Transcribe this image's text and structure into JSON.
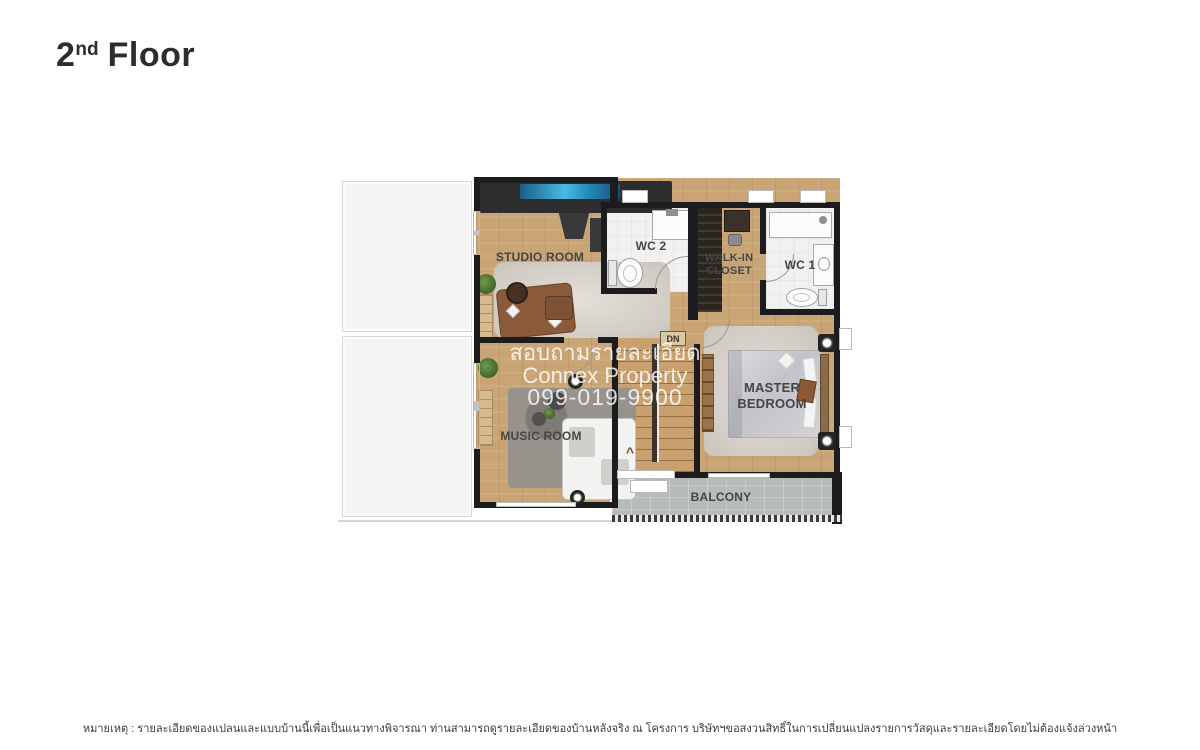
{
  "page": {
    "title": {
      "number": "2",
      "ordinal": "nd",
      "word": "Floor"
    }
  },
  "floor_plan": {
    "rooms": {
      "studio_room": {
        "label": "STUDIO ROOM"
      },
      "wc2": {
        "label": "WC 2"
      },
      "walk_in_closet": {
        "label": "WALK-IN\nCLOSET"
      },
      "wc1": {
        "label": "WC 1"
      },
      "master_bedroom": {
        "label": "MASTER\nBEDROOM"
      },
      "music_room": {
        "label": "MUSIC ROOM"
      },
      "balcony": {
        "label": "BALCONY"
      },
      "stairs": {
        "label": "DN",
        "direction_arrow": "^"
      }
    },
    "colors": {
      "wall": "#1c1c1e",
      "wood_floor": "#c9a575",
      "white_floor": "#f1f1f0",
      "balcony_floor": "#b6bcba",
      "roof_area": "#f5f5f5",
      "tv_screen_blue": "#2f9cc6"
    }
  },
  "watermark": {
    "line1": "สอบถามรายละเอียด",
    "line2": "Connex Property",
    "line3": "099-019-9900"
  },
  "disclaimer": {
    "text": "หมายเหตุ : รายละเอียดของแปลนและแบบบ้านนี้เพื่อเป็นแนวทางพิจารณา ท่านสามารถดูรายละเอียดของบ้านหลังจริง ณ โครงการ บริษัทฯขอสงวนสิทธิ์ในการเปลี่ยนแปลงรายการวัสดุและรายละเอียดโดยไม่ต้องแจ้งล่วงหน้า"
  }
}
